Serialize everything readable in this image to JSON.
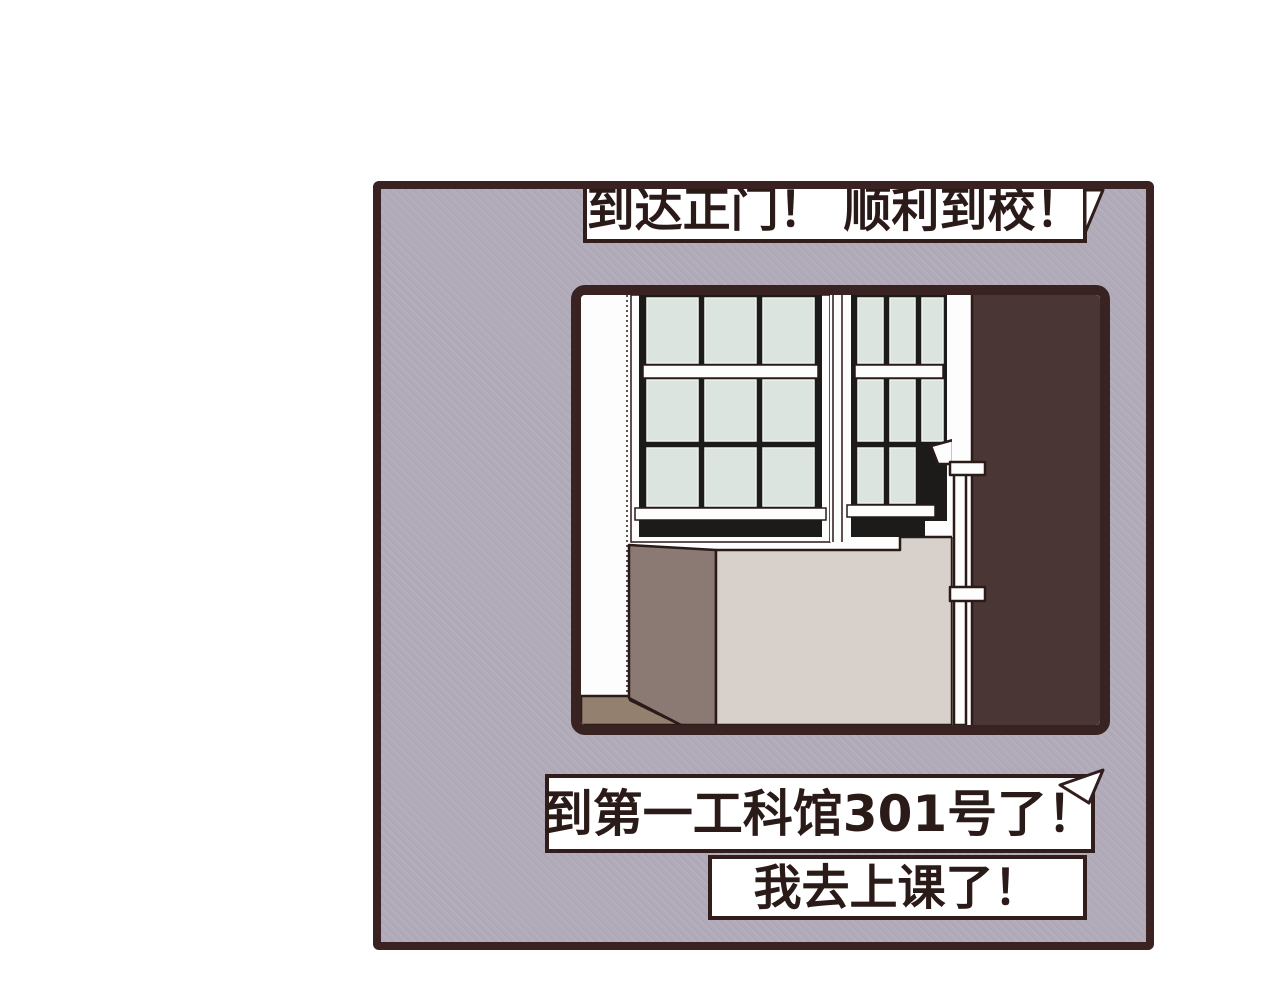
{
  "bubbles": {
    "top": {
      "text": "到达正门！ 顺利到校！"
    },
    "middle": {
      "text": "到第一工科馆301号了！"
    },
    "bottom": {
      "text": "我去上课了！"
    }
  },
  "colors": {
    "page_bg": "#ffffff",
    "panel_bg": "#b1abb9",
    "panel_border": "#392221",
    "bubble_bg": "#ffffff",
    "bubble_border": "#301d1c",
    "text": "#2a1a18",
    "frame_border": "#392322",
    "scene_wall_white": "#fdfdfd",
    "scene_pane": "#dce4e0",
    "scene_window_frame": "#1d1b19",
    "scene_brown_wall": "#4a3635",
    "scene_box_front": "#d8d1cb",
    "scene_box_side": "#8b7a74",
    "scene_floor": "#94806f",
    "scene_outline": "#2a1a18"
  }
}
